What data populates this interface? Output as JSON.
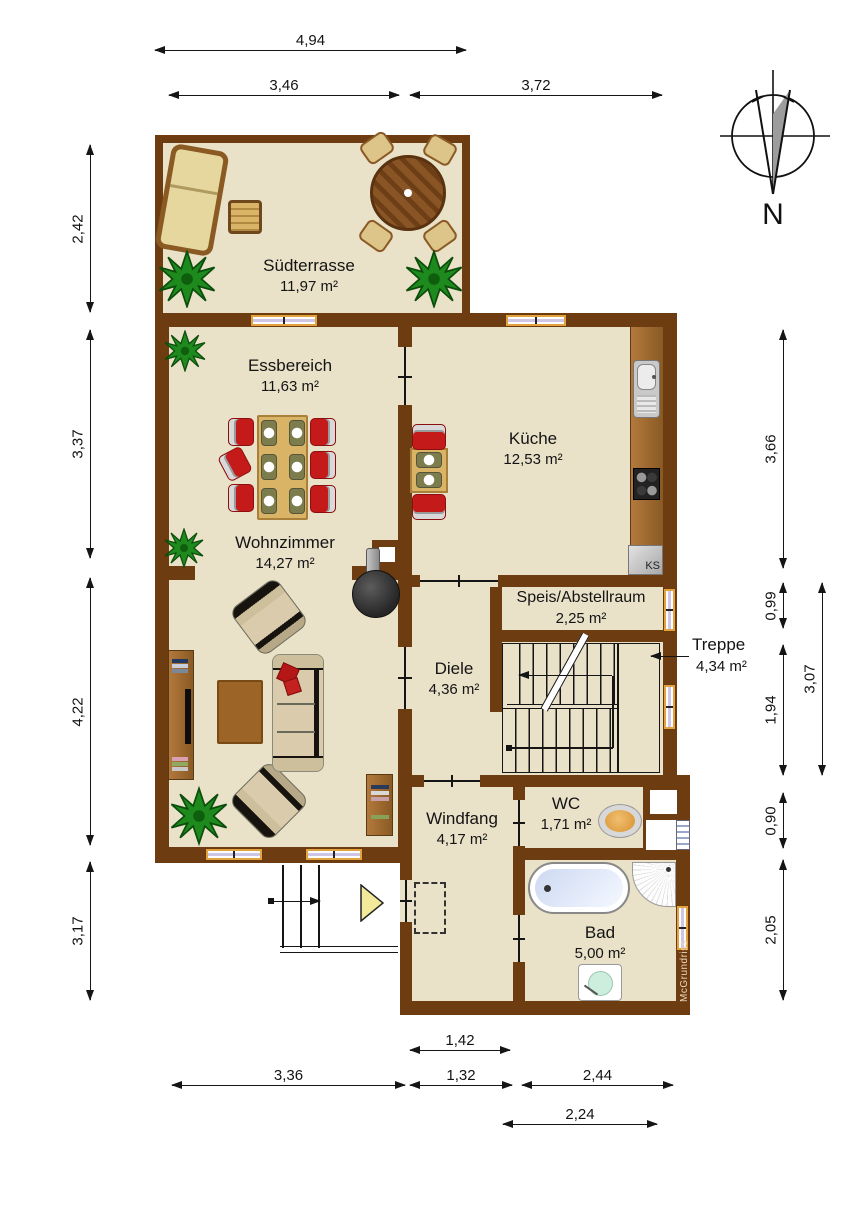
{
  "plan": {
    "compass_label": "N",
    "watermark": "McGrundriss",
    "fridge_label": "KS"
  },
  "rooms": [
    {
      "name": "Südterrasse",
      "area": "11,97 m²"
    },
    {
      "name": "Essbereich",
      "area": "11,63 m²"
    },
    {
      "name": "Küche",
      "area": "12,53 m²"
    },
    {
      "name": "Wohnzimmer",
      "area": "14,27 m²"
    },
    {
      "name": "Speis/Abstellraum",
      "area": "2,25 m²"
    },
    {
      "name": "Diele",
      "area": "4,36 m²"
    },
    {
      "name": "Treppe",
      "area": "4,34 m²"
    },
    {
      "name": "Windfang",
      "area": "4,17 m²"
    },
    {
      "name": "WC",
      "area": "1,71 m²"
    },
    {
      "name": "Bad",
      "area": "5,00 m²"
    }
  ],
  "dims": {
    "top": [
      "4,94",
      "3,46",
      "3,72"
    ],
    "left": [
      "2,42",
      "3,37",
      "4,22",
      "3,17"
    ],
    "right": [
      "3,66",
      "0,99",
      "1,94",
      "3,07",
      "0,90",
      "2,05"
    ],
    "bottom": [
      "1,42",
      "3,36",
      "1,32",
      "2,44",
      "2,24"
    ]
  },
  "colors": {
    "wall": "#6d3c11",
    "floor": "#e9e1c8",
    "window_frame": "#e2a23f",
    "chair_red": "#c41a1a",
    "plant_green": "#1e8a1e",
    "stove_black": "#222222"
  }
}
